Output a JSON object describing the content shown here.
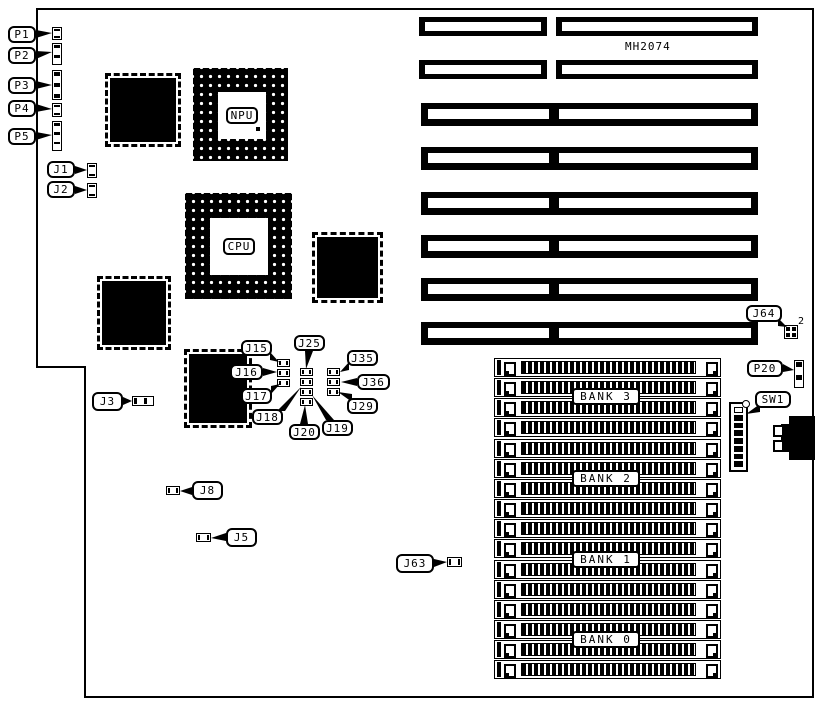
{
  "part_number": "MH2074",
  "sockets": {
    "npu": "NPU",
    "cpu": "CPU"
  },
  "j64_pin_label": "2",
  "banks": [
    "BANK 3",
    "BANK 2",
    "BANK 1",
    "BANK 0"
  ],
  "callouts": [
    {
      "id": "P1",
      "text": "P1"
    },
    {
      "id": "P2",
      "text": "P2"
    },
    {
      "id": "P3",
      "text": "P3"
    },
    {
      "id": "P4",
      "text": "P4"
    },
    {
      "id": "P5",
      "text": "P5"
    },
    {
      "id": "J1",
      "text": "J1"
    },
    {
      "id": "J2",
      "text": "J2"
    },
    {
      "id": "J3",
      "text": "J3"
    },
    {
      "id": "J8",
      "text": "J8"
    },
    {
      "id": "J5",
      "text": "J5"
    },
    {
      "id": "J63",
      "text": "J63"
    },
    {
      "id": "J64",
      "text": "J64"
    },
    {
      "id": "P20",
      "text": "P20"
    },
    {
      "id": "SW1",
      "text": "SW1"
    },
    {
      "id": "J15",
      "text": "J15"
    },
    {
      "id": "J16",
      "text": "J16"
    },
    {
      "id": "J17",
      "text": "J17"
    },
    {
      "id": "J25",
      "text": "J25"
    },
    {
      "id": "J18",
      "text": "J18"
    },
    {
      "id": "J20",
      "text": "J20"
    },
    {
      "id": "J19",
      "text": "J19"
    },
    {
      "id": "J35",
      "text": "J35"
    },
    {
      "id": "J36",
      "text": "J36"
    },
    {
      "id": "J29",
      "text": "J29"
    }
  ]
}
